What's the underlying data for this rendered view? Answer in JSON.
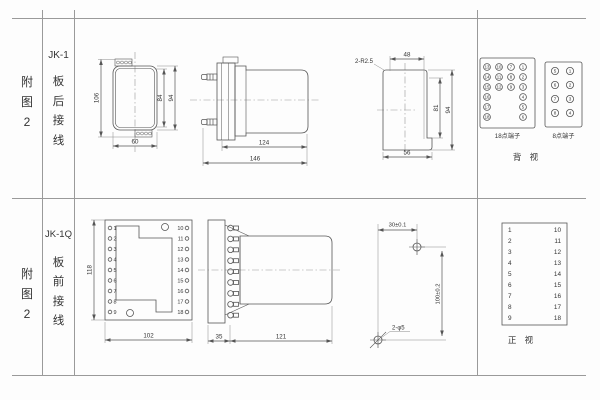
{
  "row1": {
    "fig_chars": [
      "附",
      "图",
      "2"
    ],
    "model": "JK-1",
    "wiring_chars": [
      "板",
      "后",
      "接",
      "线"
    ],
    "front_view": {
      "dim_total_height": "106",
      "dim_inner_height": "84",
      "dim_outer_height": "94",
      "dim_width": "60"
    },
    "side_view": {
      "dim_body_length": "124",
      "dim_total_length": "146"
    },
    "cutout_view": {
      "corner_note": "2-R2.5",
      "dim_top_width": "48",
      "dim_inner_height": "81",
      "dim_outer_height": "94",
      "dim_bottom_width": "56"
    },
    "rear_view": {
      "block18": {
        "label": "18点端子",
        "rows": [
          [
            13,
            10,
            7,
            1
          ],
          [
            14,
            11,
            8,
            2
          ],
          [
            15,
            12,
            9,
            3
          ],
          [
            16,
            null,
            null,
            4
          ],
          [
            17,
            null,
            null,
            5
          ],
          [
            18,
            null,
            null,
            6
          ]
        ]
      },
      "block8": {
        "label": "8点端子",
        "rows": [
          [
            5,
            1
          ],
          [
            6,
            2
          ],
          [
            7,
            3
          ],
          [
            8,
            4
          ]
        ]
      },
      "view_label": "背 视"
    }
  },
  "row2": {
    "fig_chars": [
      "附",
      "图",
      "2"
    ],
    "model": "JK-1Q",
    "wiring_chars": [
      "板",
      "前",
      "接",
      "线"
    ],
    "plate_view": {
      "dim_height": "118",
      "dim_width": "102",
      "left_terminals": [
        "1",
        "2",
        "3",
        "4",
        "5",
        "6",
        "7",
        "8",
        "9"
      ],
      "right_terminals": [
        "10",
        "11",
        "12",
        "13",
        "14",
        "15",
        "16",
        "17",
        "18"
      ]
    },
    "side_view": {
      "dim_plate": "35",
      "dim_body": "121"
    },
    "drill_view": {
      "dim_horizontal": "30±0.1",
      "dim_vertical": "100±0.2",
      "hole_note": "2-φ5"
    },
    "front_view": {
      "left_terminals": [
        "1",
        "2",
        "3",
        "4",
        "5",
        "6",
        "7",
        "8",
        "9"
      ],
      "right_terminals": [
        "10",
        "11",
        "12",
        "13",
        "14",
        "15",
        "16",
        "17",
        "18"
      ],
      "view_label": "正 视"
    }
  }
}
